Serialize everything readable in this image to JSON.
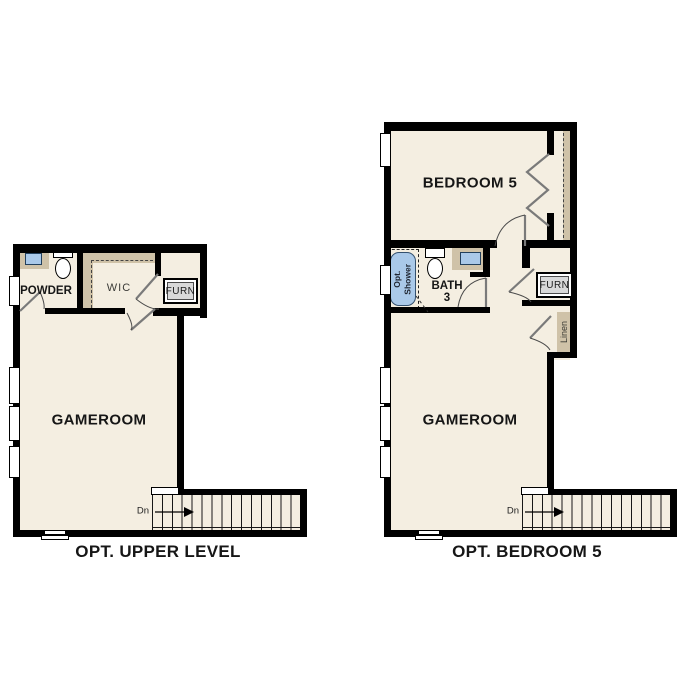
{
  "colors": {
    "floor": "#f4eee1",
    "wall": "#000000",
    "cabinet_tan": "#cfc2a8",
    "fixture_blue": "#aac9e9",
    "furnace_gray": "#d9d9d9"
  },
  "plans": [
    {
      "title": "OPT. UPPER LEVEL",
      "rooms": {
        "powder": "POWDER",
        "wic": "WIC",
        "furnace": "FURN",
        "gameroom": "GAMEROOM"
      },
      "stairs": {
        "down_label": "Dn"
      }
    },
    {
      "title": "OPT. BEDROOM 5",
      "rooms": {
        "bedroom": "BEDROOM 5",
        "bath_line1": "BATH",
        "bath_line2": "3",
        "shower_line1": "Opt.",
        "shower_line2": "Shower",
        "furnace": "FURN",
        "linen": "Linen",
        "gameroom": "GAMEROOM"
      },
      "stairs": {
        "down_label": "Dn"
      }
    }
  ]
}
